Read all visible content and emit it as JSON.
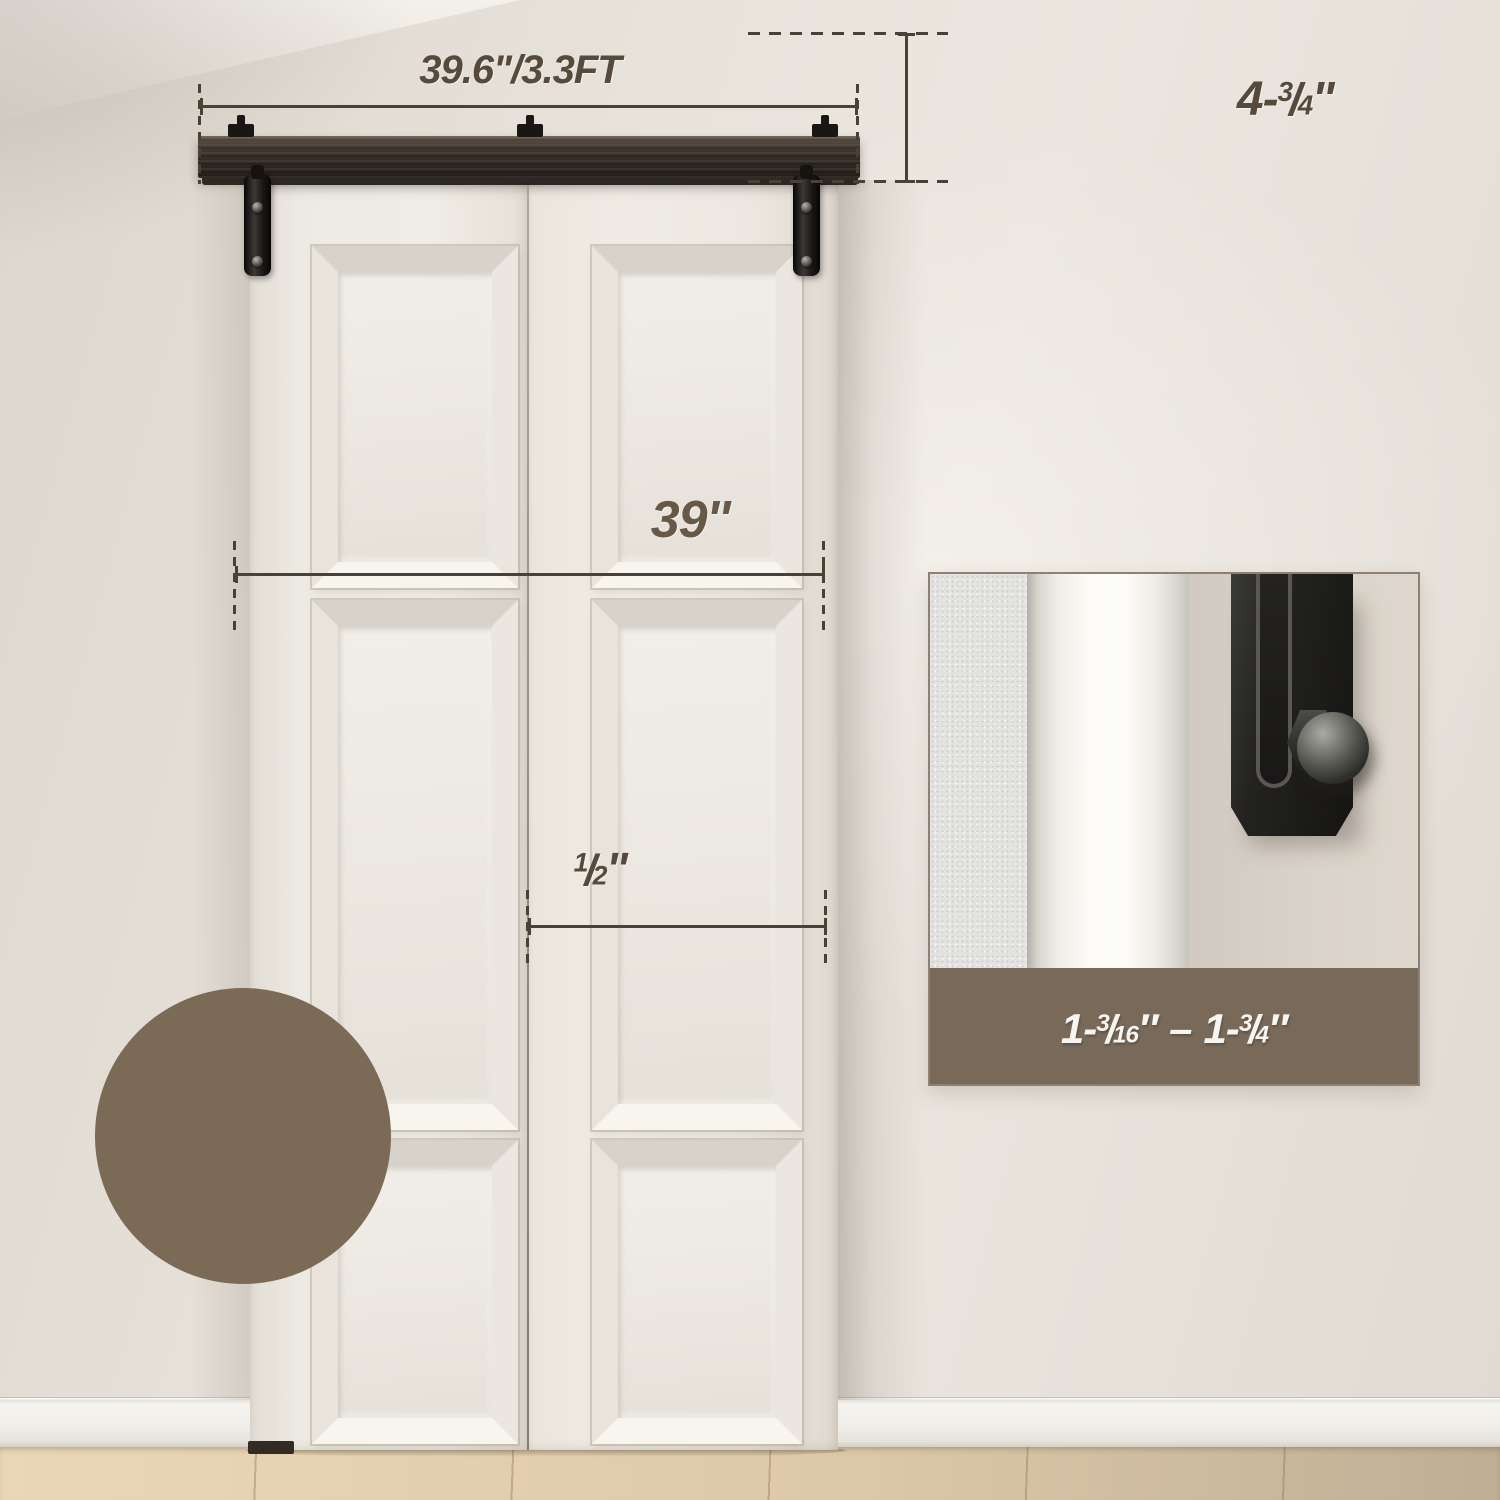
{
  "scene": {
    "track_width_label": "39.6\"/3.3FT",
    "track_height": {
      "whole": "4",
      "dash": "-",
      "num": "3",
      "slash": "/",
      "den": "4",
      "unit": "''"
    },
    "door_width_label": "39''",
    "half_inch": {
      "num": "1",
      "slash": "/",
      "den": "2",
      "unit": "''"
    },
    "inset_caption": {
      "min": {
        "whole": "1-",
        "num": "3",
        "slash": "/",
        "den": "16",
        "unit": "″"
      },
      "dash": "–",
      "max": {
        "whole": "1-",
        "num": "3",
        "slash": "/",
        "den": "4",
        "unit": "″"
      }
    },
    "colors": {
      "swatch_brown": "#7b6a55",
      "caption_band_brown": "#786959",
      "dimension_text": "#554a3c",
      "dimension_line": "#4a4136",
      "track_dark": "#2a241f",
      "wall": "#e8e3dc",
      "door_white": "#efece5",
      "floor_wood": "#dcc8a7"
    }
  }
}
